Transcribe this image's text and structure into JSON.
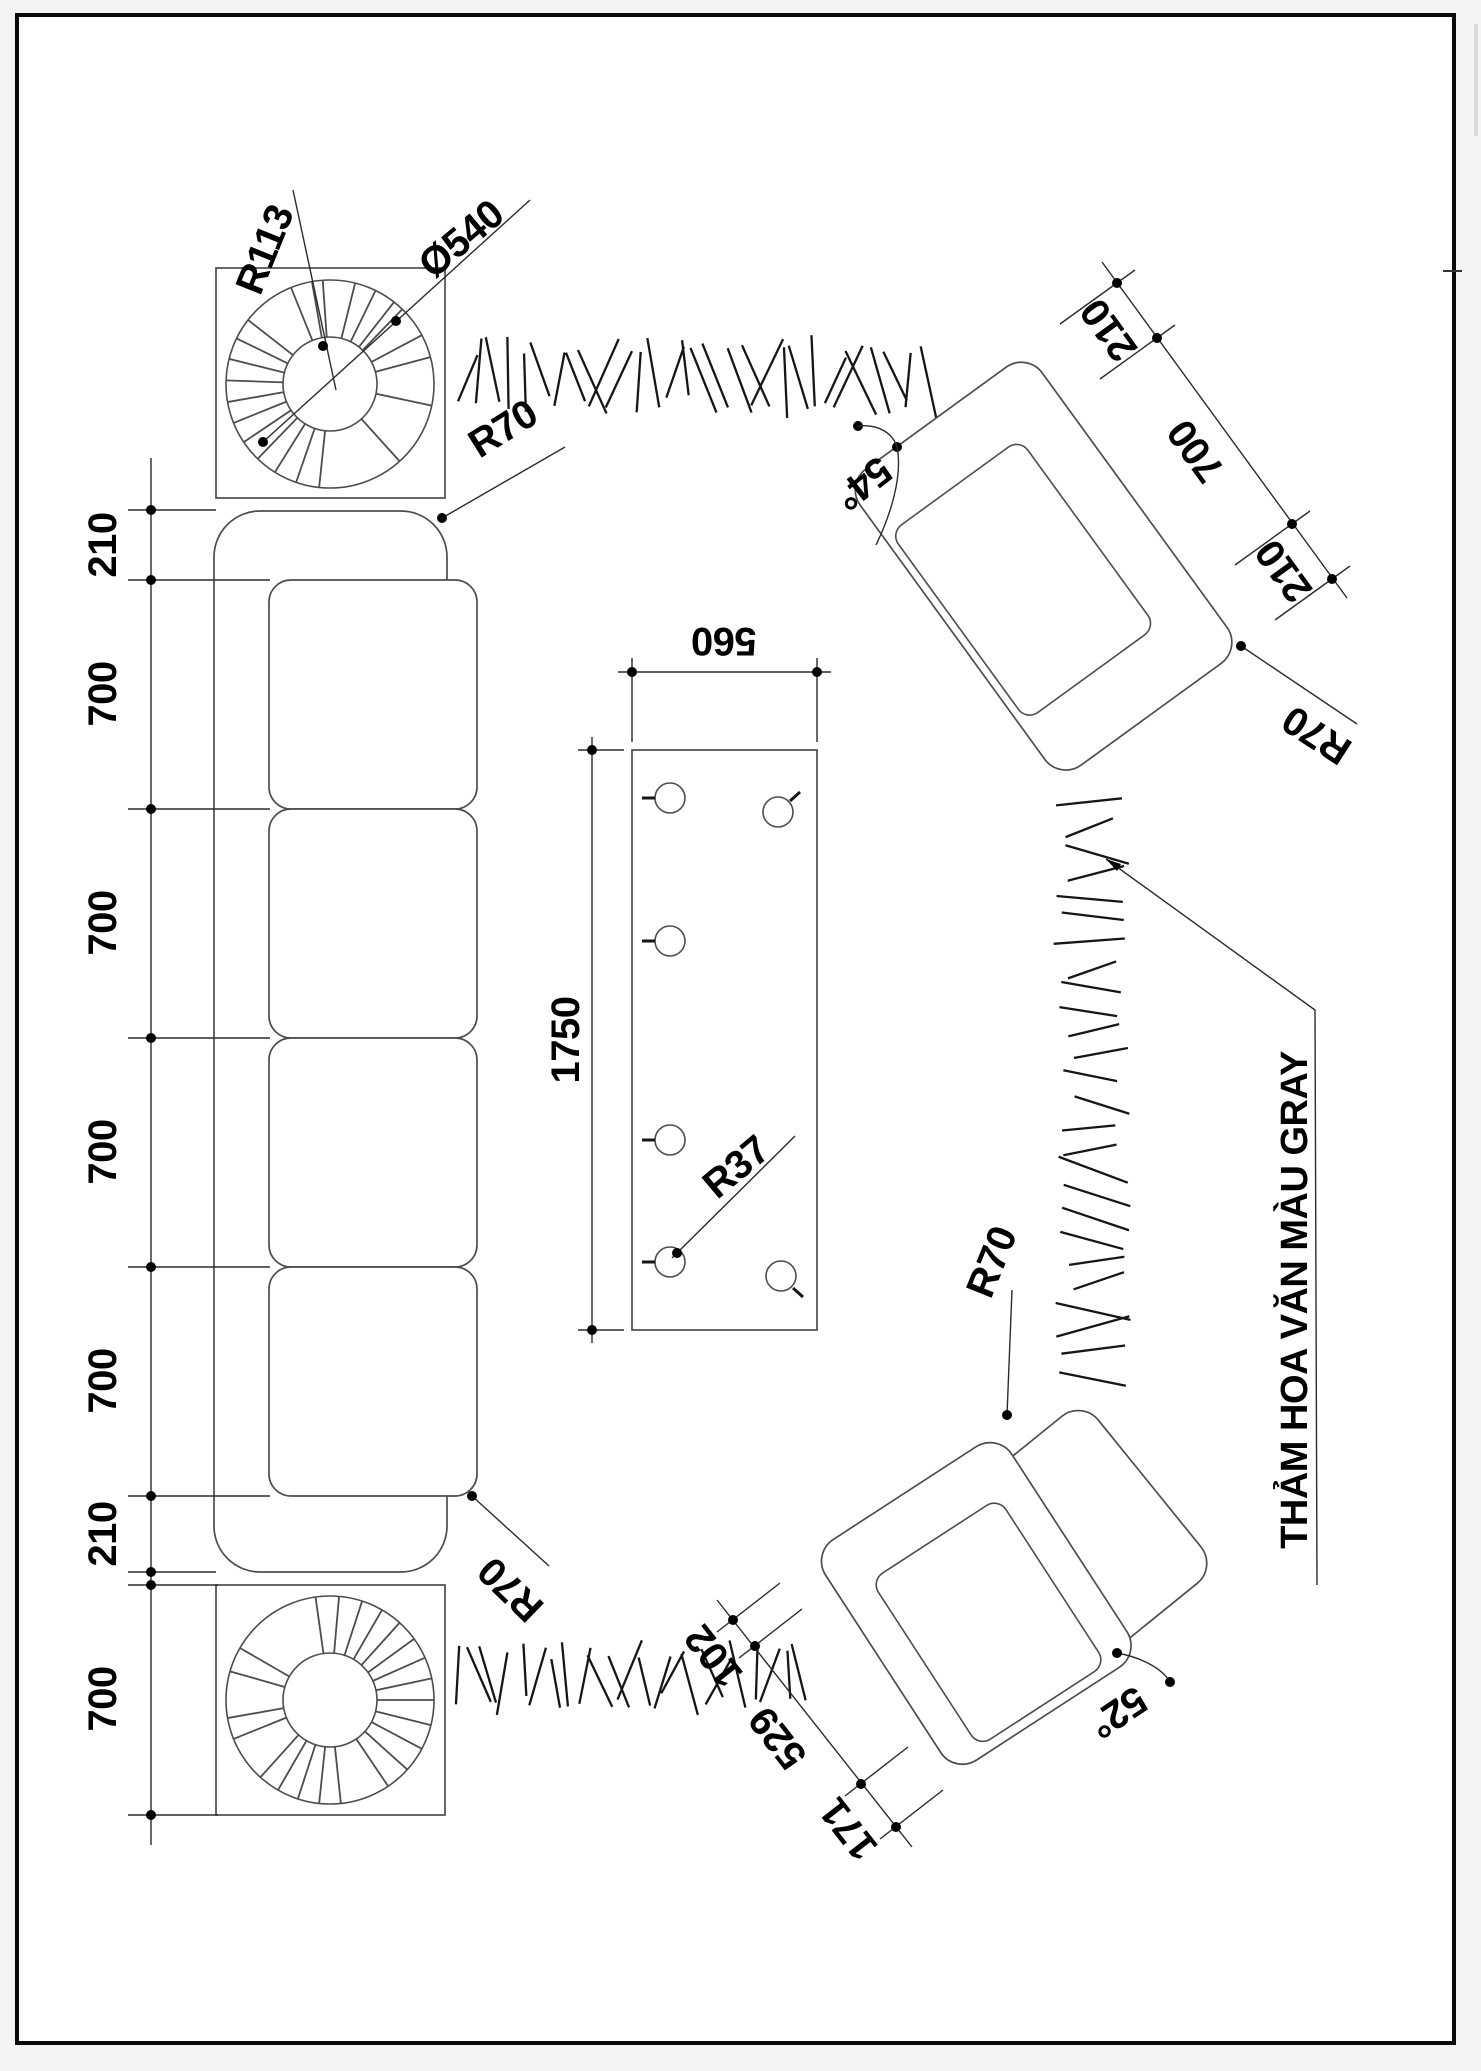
{
  "title": "Living room furniture layout plan (CAD)",
  "colors": {
    "paper": "#ffffff",
    "frame": "#0a0a0a",
    "furniture_line": "#4d4d4d",
    "dimension_line": "#2b2b2b",
    "hatch_line": "#161616",
    "text": "#000000",
    "scroll_hint": "#cfcfcf"
  },
  "labels": {
    "r113": "R113",
    "d540": "Ø540",
    "r70": "R70",
    "r37": "R37",
    "a54": "54°",
    "a52": "52°",
    "w560": "560",
    "h1750": "1750",
    "carpet": "THẢM HOA VĂN MÀU GRAY"
  },
  "left_chain": {
    "values": [
      "210",
      "700",
      "700",
      "700",
      "700",
      "210",
      "700"
    ]
  },
  "top_chain": {
    "values": [
      "210",
      "700",
      "210"
    ]
  },
  "bottom_chain": {
    "values": [
      "102",
      "529",
      "171"
    ]
  },
  "spokes": {
    "top": [
      96,
      109,
      122,
      134,
      146,
      158,
      170,
      182,
      194,
      206,
      218,
      248,
      260,
      266,
      284,
      296,
      308,
      314,
      332,
      345,
      12,
      48
    ],
    "bottom": [
      262,
      275,
      288,
      300,
      312,
      324,
      336,
      348,
      0,
      14,
      28,
      42,
      56,
      84,
      96,
      108,
      120,
      132,
      158,
      170,
      196,
      210
    ]
  },
  "hatch_bands": [
    {
      "x": 455,
      "y": 348,
      "w": 480,
      "h": 54,
      "n": 30,
      "len": 64,
      "orient": "h",
      "lean": 26,
      "seed": 7
    },
    {
      "x": 1058,
      "y": 795,
      "w": 74,
      "h": 592,
      "n": 26,
      "len": 64,
      "orient": "v",
      "lean": 22,
      "seed": 13
    },
    {
      "x": 452,
      "y": 1648,
      "w": 356,
      "h": 58,
      "n": 23,
      "len": 60,
      "orient": "h",
      "lean": 30,
      "seed": 21
    }
  ]
}
